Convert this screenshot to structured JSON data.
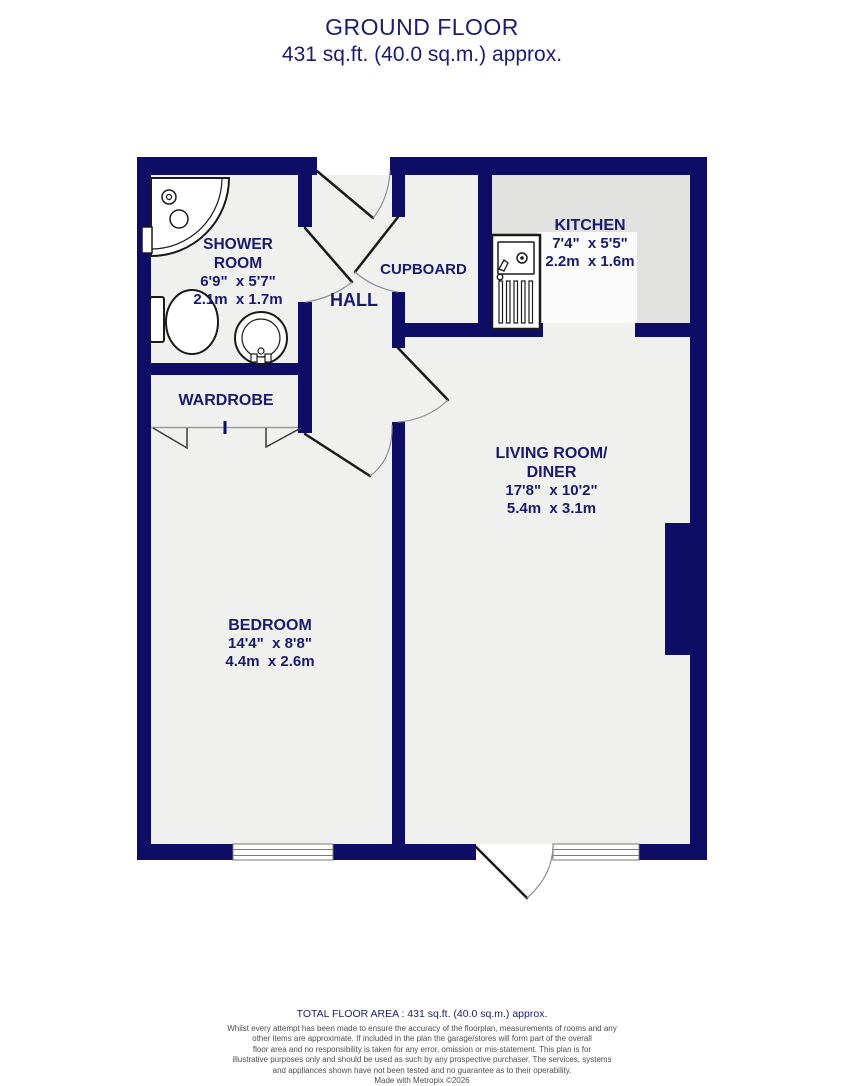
{
  "title": {
    "line1": "GROUND FLOOR",
    "line2": "431 sq.ft. (40.0 sq.m.) approx."
  },
  "rooms": {
    "shower_room": {
      "name_line1": "SHOWER",
      "name_line2": "ROOM",
      "size_imperial": "6'9\"  x 5'7\"",
      "size_metric": "2.1m  x 1.7m"
    },
    "hall": {
      "name": "HALL"
    },
    "cupboard": {
      "name": "CUPBOARD"
    },
    "kitchen": {
      "name": "KITCHEN",
      "size_imperial": "7'4\"  x 5'5\"",
      "size_metric": "2.2m  x 1.6m"
    },
    "wardrobe": {
      "name": "WARDROBE"
    },
    "living_room": {
      "name_line1": "LIVING ROOM/",
      "name_line2": "DINER",
      "size_imperial": "17'8\"  x 10'2\"",
      "size_metric": "5.4m  x 3.1m"
    },
    "bedroom": {
      "name": "BEDROOM",
      "size_imperial": "14'4\"  x 8'8\"",
      "size_metric": "4.4m  x 2.6m"
    }
  },
  "footer": {
    "total_area": "TOTAL FLOOR AREA : 431 sq.ft. (40.0 sq.m.) approx.",
    "disclaimer_lines": [
      "Whilst every attempt has been made to ensure the accuracy of the floorplan, measurements of rooms and any",
      "other items are approximate. If included in the plan the garage/stores will form part of the overall",
      "floor area and no responsibility is taken for any error, omission or mis-statement. This plan is for",
      "illustrative purposes only and should be used as such by any prospective purchaser. The services, systems",
      "and appliances shown have not been tested and no guarantee as to their operability."
    ],
    "credit": "Made with Metropix ©2026"
  },
  "colors": {
    "wall": "#0d0d66",
    "label_text": "#1a1a6d",
    "floor": "#f0f0ef",
    "kitchen_counter": "#e2e2e1"
  }
}
